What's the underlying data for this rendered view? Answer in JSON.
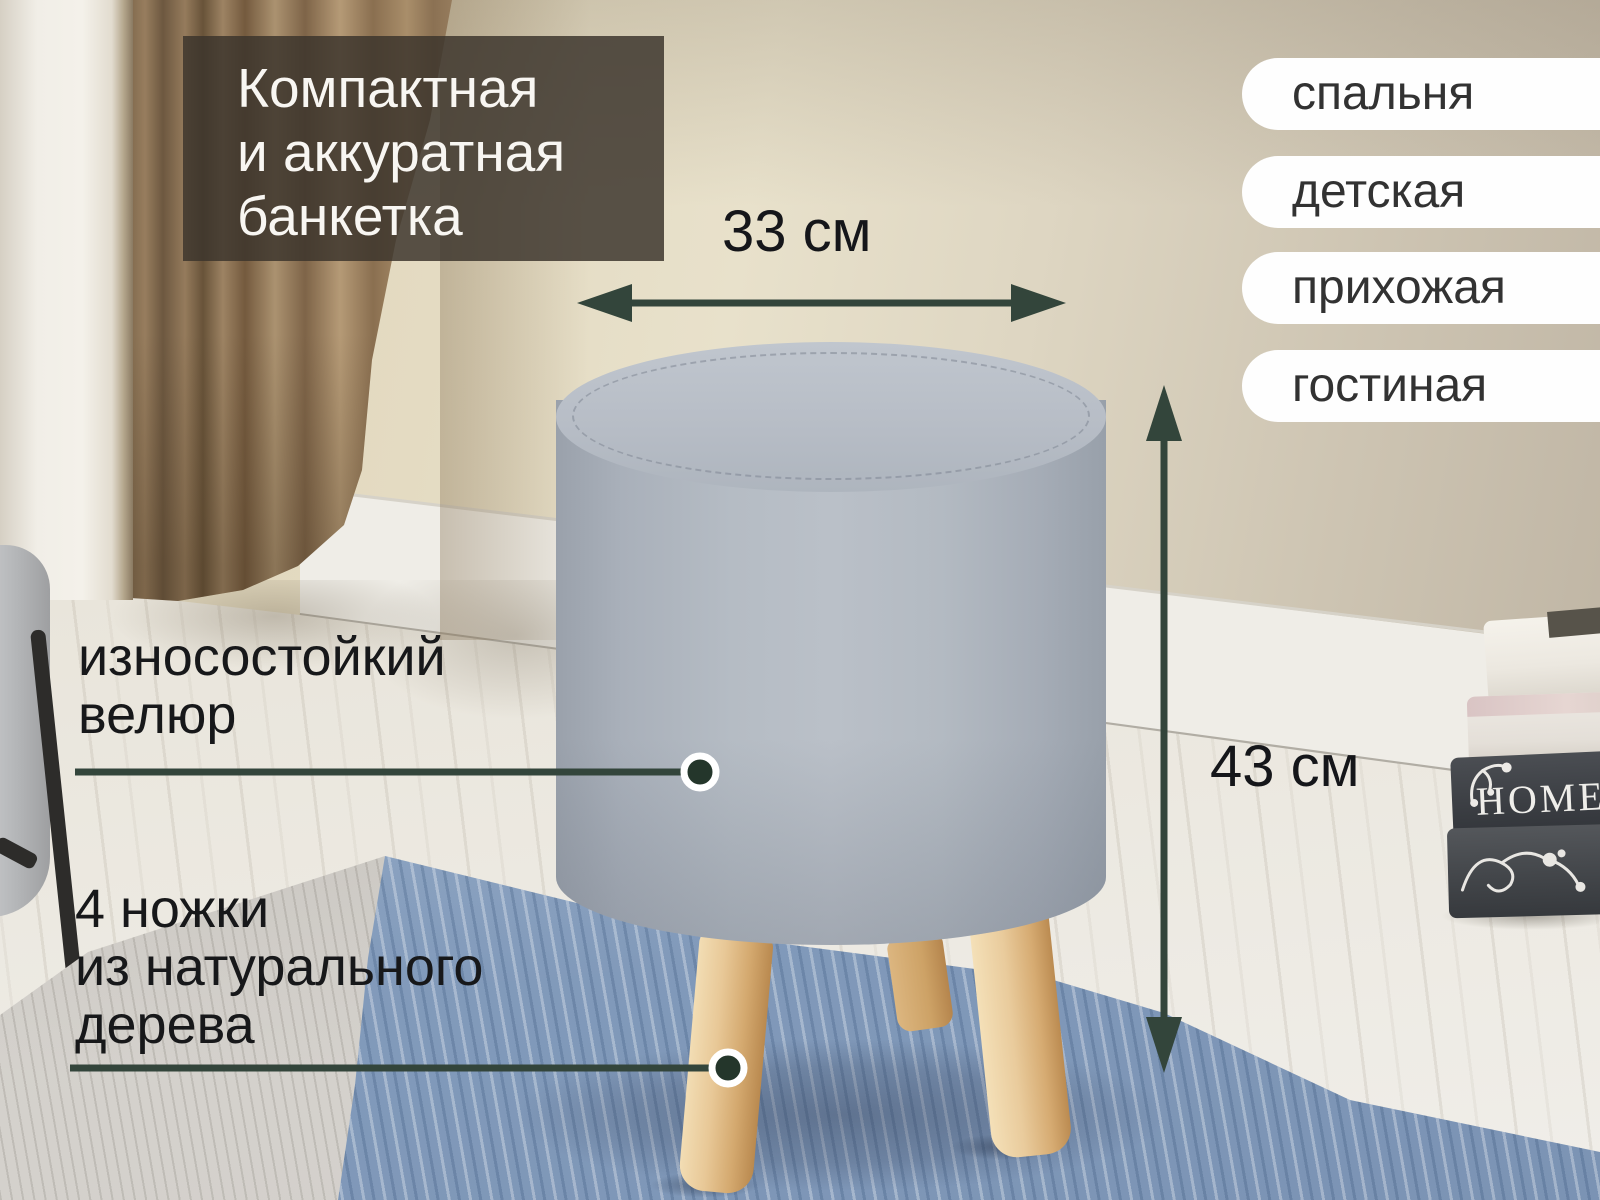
{
  "product": {
    "headline": "Компактная\nи аккуратная\nбанкетка",
    "width_label": "33 см",
    "height_label": "43 см",
    "seat_feature": "износостойкий\nвелюр",
    "legs_feature": "4 ножки\nиз натурального\nдерева"
  },
  "room_tags": [
    {
      "label": "спальня"
    },
    {
      "label": "детская"
    },
    {
      "label": "прихожая"
    },
    {
      "label": "гостиная"
    }
  ],
  "decor": {
    "book_spine_title": "HOME"
  },
  "colors": {
    "accent_arrow_green": "#33453b",
    "marker_dot_fill": "#24362b",
    "headline_overlay": "rgba(59,53,44,0.84)",
    "tag_pill_bg": "#fefefe",
    "tag_text": "#323232",
    "annotation_text": "#17181a",
    "ottoman_fabric": "#b5bcc4",
    "leg_wood": "#dcb987",
    "rug_blue": "#87a0bf",
    "curtain_brown": "#8a7052",
    "wall_beige": "#e4dbc2"
  }
}
